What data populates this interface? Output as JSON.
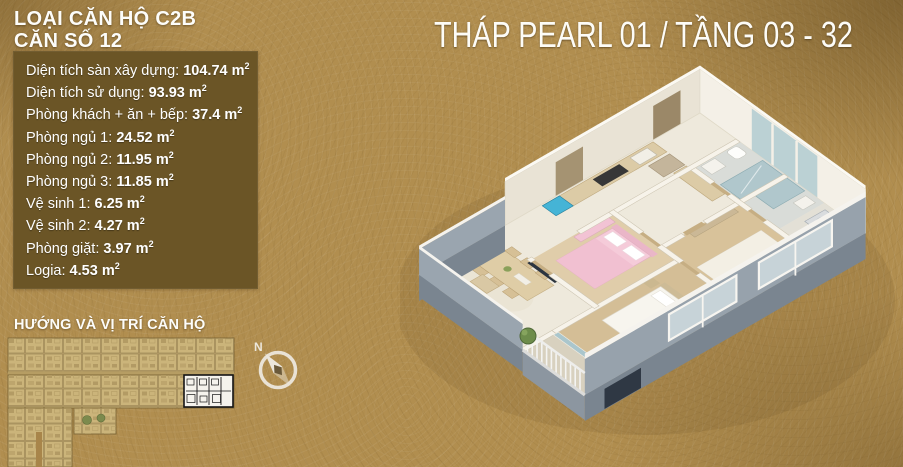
{
  "header": {
    "type_line1": "LOẠI CĂN HỘ C2B",
    "type_line2": "CĂN SỐ 12",
    "main_title": "THÁP PEARL 01 / TẦNG 03 - 32"
  },
  "specs": {
    "items": [
      {
        "label": "Diện tích sàn xây dựng",
        "value": "104.74"
      },
      {
        "label": "Diện tích sử dụng",
        "value": "93.93"
      },
      {
        "label": "Phòng khách + ăn + bếp",
        "value": "37.4"
      },
      {
        "label": "Phòng ngủ 1",
        "value": "24.52"
      },
      {
        "label": "Phòng ngủ 2",
        "value": "11.95"
      },
      {
        "label": "Phòng ngủ 3",
        "value": "11.85"
      },
      {
        "label": "Vệ sinh 1",
        "value": "6.25"
      },
      {
        "label": "Vệ sinh 2",
        "value": "4.27"
      },
      {
        "label": "Phòng giặt",
        "value": "3.97"
      },
      {
        "label": "Logia",
        "value": "4.53"
      }
    ],
    "unit_base": "m",
    "unit_exponent": "2"
  },
  "location": {
    "title": "HƯỚNG VÀ VỊ TRÍ CĂN HỘ",
    "compass_label": "N"
  },
  "colors": {
    "background_gold": "#b18e4f",
    "panel_brown": "#6b5526",
    "text_white": "#ffffff",
    "diagram_beige": "#cbb47a",
    "diagram_line": "#7d6737",
    "highlight_unit_bg": "#f5f3ed",
    "highlight_unit_wall": "#141414",
    "exterior_wall_gray": "#97a2ac",
    "bedroom_pink": "#f5cbd9",
    "glass_blue": "#aac6cc",
    "wood_floor": "#d8c29a"
  }
}
